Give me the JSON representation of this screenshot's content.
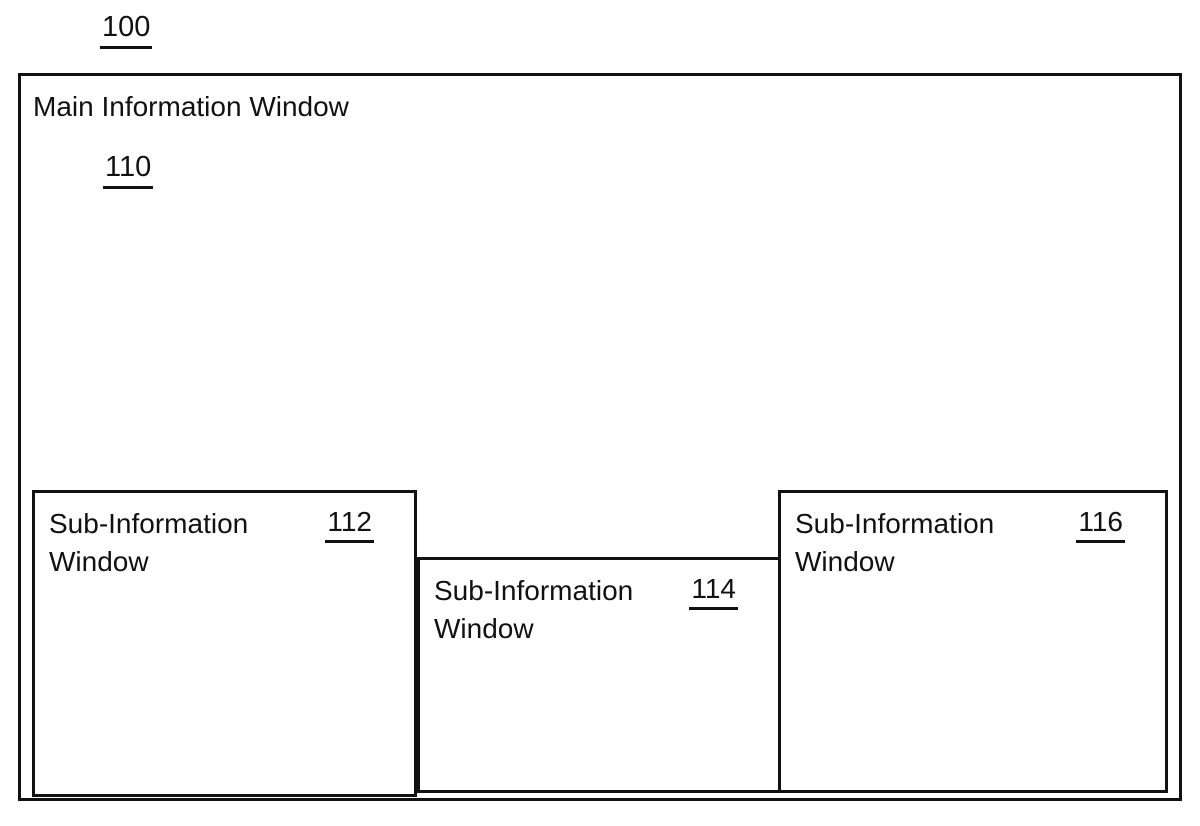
{
  "figure": {
    "reference_label": "100",
    "main_window": {
      "title": "Main Information Window",
      "reference": "110"
    },
    "sub_windows": [
      {
        "title_line1": "Sub-Information",
        "title_line2": "Window",
        "reference": "112"
      },
      {
        "title_line1": "Sub-Information",
        "title_line2": "Window",
        "reference": "114"
      },
      {
        "title_line1": "Sub-Information",
        "title_line2": "Window",
        "reference": "116"
      }
    ],
    "colors": {
      "line": "#111111",
      "background": "#ffffff"
    }
  }
}
